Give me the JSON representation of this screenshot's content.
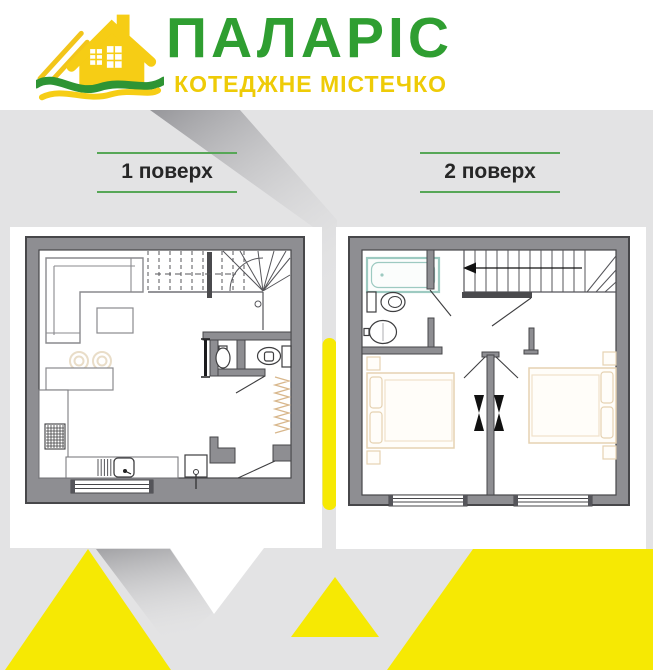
{
  "header": {
    "brand": "ПАЛАРІС",
    "tagline": "КОТЕДЖНЕ МІСТЕЧКО"
  },
  "floors": [
    {
      "label": "1 поверх"
    },
    {
      "label": "2 поверх"
    }
  ],
  "colors": {
    "brand_green": "#2f9e31",
    "brand_yellow": "#eecb07",
    "accent_yellow": "#f6e903",
    "label_line_green": "#57a757",
    "wall_gray": "#8e8e92",
    "outline_dark": "#47474a",
    "furniture_tan": "#e5d2b2",
    "bathtub_teal": "#9dcac1",
    "background_gray": "#e3e3e4",
    "card_white": "#ffffff"
  },
  "icons": {
    "logo": "house-logo-icon",
    "plan_1": [
      "sofa-icon",
      "coffee-table-icon",
      "dining-table-icon",
      "dining-chairs-icon",
      "stove-icon",
      "kitchen-sink-icon",
      "stairs-icon",
      "bathroom-sink-icon",
      "toilet-icon",
      "coat-rack-icon",
      "water-heater-icon",
      "window"
    ],
    "plan_2": [
      "bathtub-icon",
      "toilet-icon",
      "bathroom-sink-icon",
      "stairs-icon",
      "direction-arrow-icon",
      "bed-icon",
      "nightstand-icon",
      "door-leaves-icon",
      "window"
    ]
  }
}
